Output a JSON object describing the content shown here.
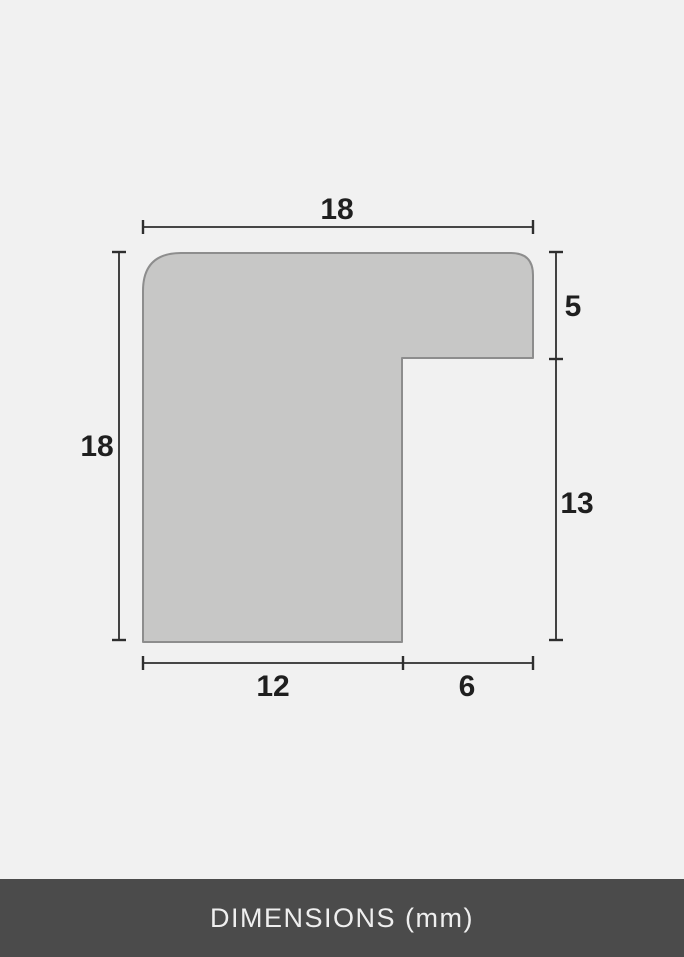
{
  "diagram": {
    "title": "frame moulding profile cross-section",
    "unit": "mm",
    "dimensions_mm": {
      "top_width": "18",
      "left_height": "18",
      "right_upper": "5",
      "right_lower": "13",
      "bottom_left": "12",
      "bottom_right": "6"
    },
    "colors": {
      "background": "#f1f1f1",
      "shape_fill": "#c7c7c6",
      "shape_outline": "#8d8d8d",
      "dimension_lines": "#2e2e2e",
      "label_text": "#1f1f1f"
    }
  },
  "footer": {
    "label": "DIMENSIONS (mm)",
    "background": "#4b4b4b",
    "text_color": "#efefef"
  }
}
